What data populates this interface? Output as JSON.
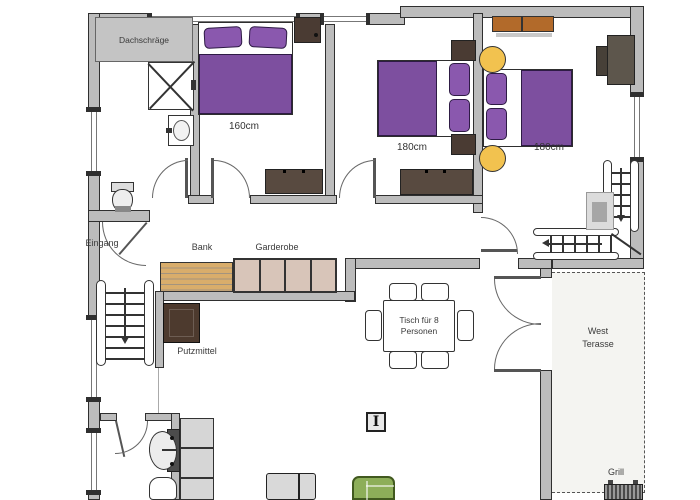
{
  "plan": {
    "rooms": {
      "bathroom_upper": {
        "attic_label": "Dachschräge"
      },
      "bedroom_1": {
        "bed_size": "160cm"
      },
      "bedroom_2": {
        "bed_size": "180cm"
      },
      "bedroom_3": {
        "bed_size": "180cm"
      }
    },
    "hallway": {
      "entrance_label": "Eingang",
      "bench_label": "Bank",
      "wardrobe_label": "Garderobe",
      "cleaning_label": "Putzmittel"
    },
    "dining": {
      "table_line1": "Tisch für 8",
      "table_line2": "Personen"
    },
    "terrace": {
      "name_line1": "West",
      "name_line2": "Terasse",
      "grill_label": "Grill"
    },
    "column_symbol": "I",
    "colors": {
      "wall": "#bcbcbc",
      "wall_border": "#2f2f2f",
      "bed_purple": "#7d4f9f",
      "pillow_purple": "#8a58ae",
      "blanket_border": "#2e1b45",
      "stool_yellow": "#f2c24f",
      "bench_wood": "#d9ad6b",
      "wardrobe_panel": "#d8c5b9",
      "dresser_brown": "#584a40",
      "nightstand_brown": "#4a3b33",
      "closet_brown": "#4d3a2e",
      "shelf_orange": "#b26a2a",
      "tv_gray": "#5d564c",
      "sofa_green": "#8dae59",
      "sofa_border": "#41591f",
      "cabinet_gray": "#d6d6d6",
      "terrace_bg": "#f4f4f1"
    }
  }
}
